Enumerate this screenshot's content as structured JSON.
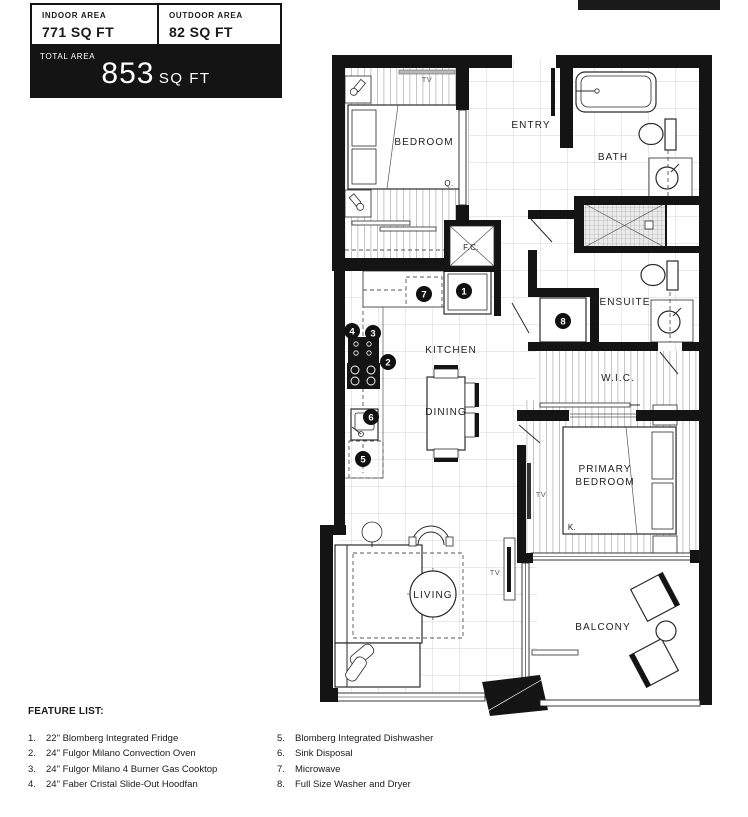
{
  "header": {
    "indoor_label": "INDOOR AREA",
    "indoor_value": "771 SQ FT",
    "outdoor_label": "OUTDOOR AREA",
    "outdoor_value": "82 SQ FT",
    "total_label": "TOTAL AREA",
    "total_value": "853",
    "total_unit": "SQ FT"
  },
  "rooms": {
    "bedroom": "BEDROOM",
    "entry": "ENTRY",
    "bath": "BATH",
    "ensuite": "ENSUITE",
    "kitchen": "KITCHEN",
    "dining": "DINING",
    "wic": "W.I.C.",
    "primary_line1": "PRIMARY",
    "primary_line2": "BEDROOM",
    "living": "LIVING",
    "balcony": "BALCONY",
    "fan_coil": "F.C.",
    "tv": "TV",
    "queen_bed": "Q.",
    "king_bed": "K."
  },
  "markers": {
    "m1": "1",
    "m2": "2",
    "m3": "3",
    "m4": "4",
    "m5": "5",
    "m6": "6",
    "m7": "7",
    "m8": "8"
  },
  "features": {
    "title": "FEATURE LIST:",
    "left": [
      {
        "num": "1.",
        "text": "22\" Blomberg Integrated Fridge"
      },
      {
        "num": "2.",
        "text": "24\" Fulgor Milano Convection Oven"
      },
      {
        "num": "3.",
        "text": "24\" Fulgor Milano 4 Burner Gas Cooktop"
      },
      {
        "num": "4.",
        "text": "24\" Faber Cristal Slide-Out Hoodfan"
      }
    ],
    "right": [
      {
        "num": "5.",
        "text": "Blomberg Integrated Dishwasher"
      },
      {
        "num": "6.",
        "text": "Sink Disposal"
      },
      {
        "num": "7.",
        "text": "Microwave"
      },
      {
        "num": "8.",
        "text": "Full Size Washer and Dryer"
      }
    ]
  },
  "colors": {
    "wall": "#141414",
    "top_bar": "#1a1a1a"
  }
}
